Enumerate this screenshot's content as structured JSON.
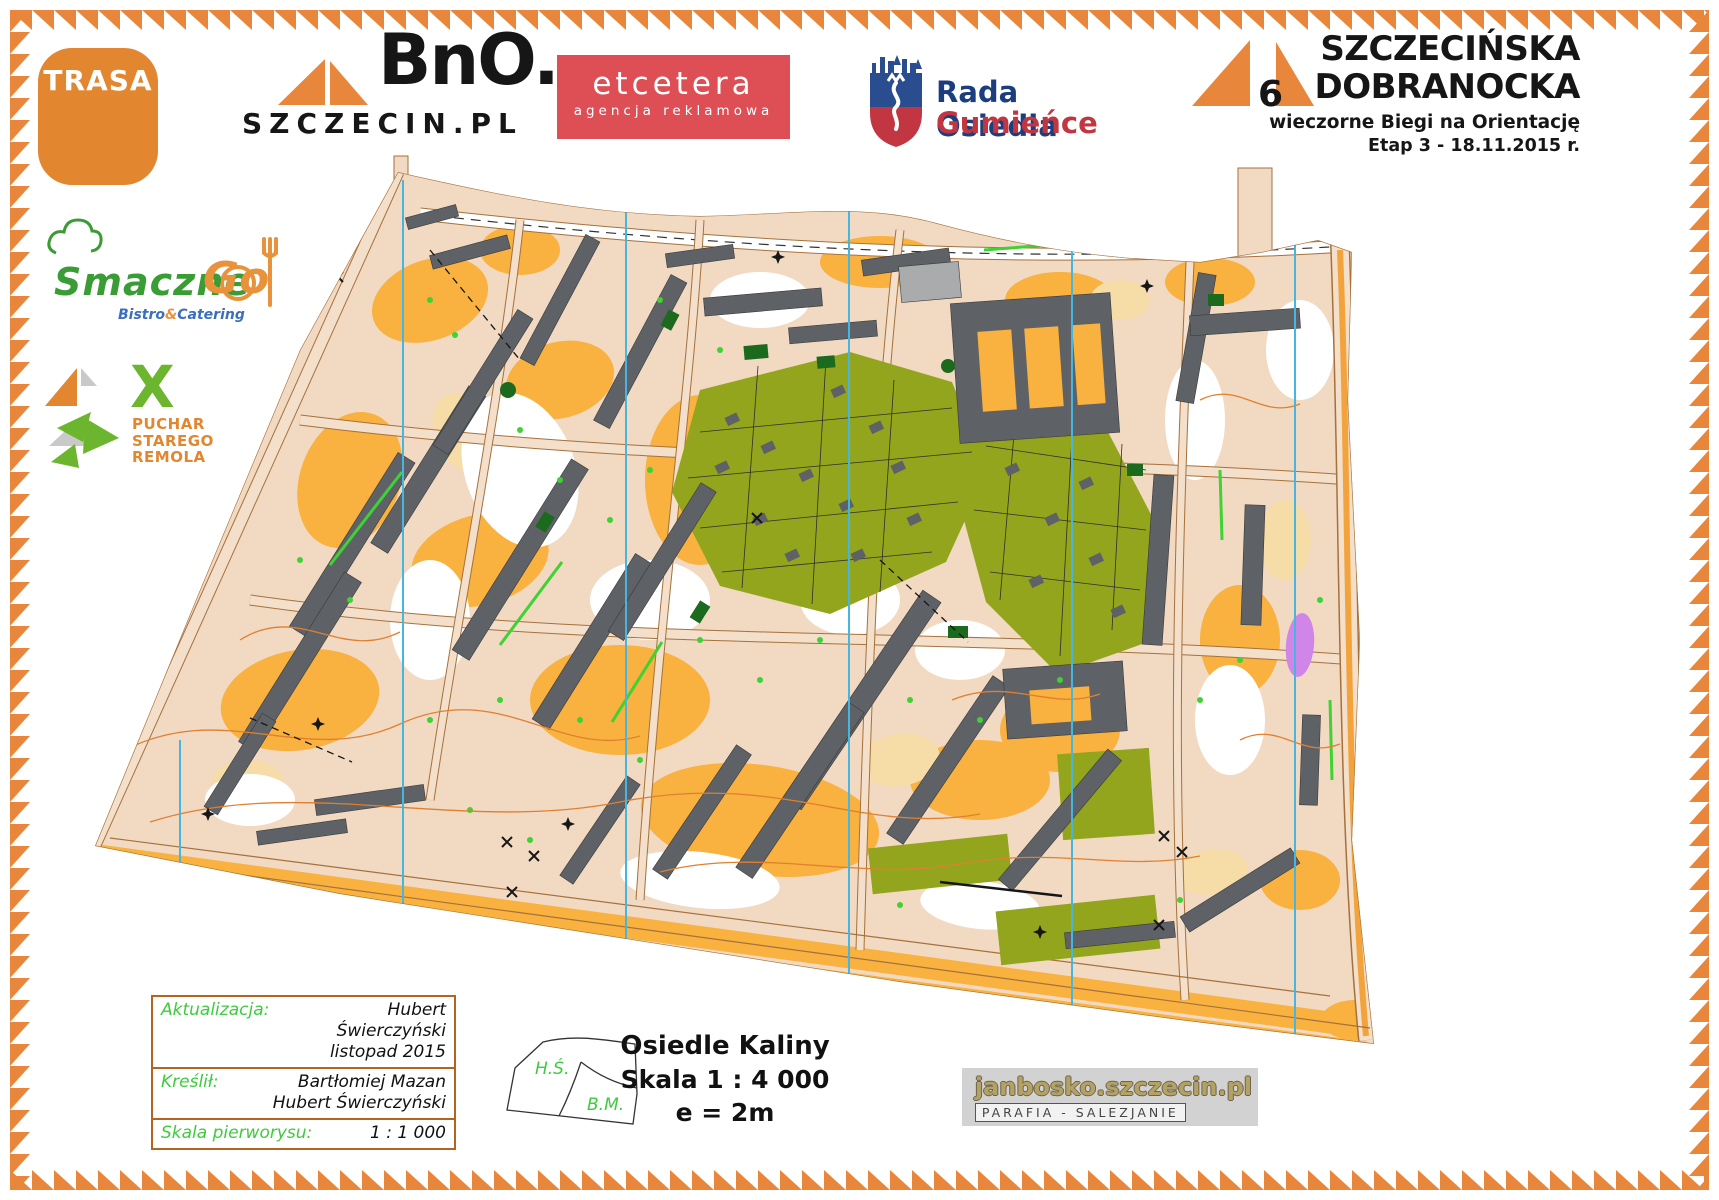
{
  "page": {
    "background": "#ffffff",
    "border_color": "#e8873b"
  },
  "header": {
    "trasa": {
      "label": "TRASA",
      "bg": "#e2862f"
    },
    "bno": {
      "name": "BnO.",
      "domain": "SZCZECIN.PL"
    },
    "etcetera": {
      "name": "etcetera",
      "tagline": "agencja reklamowa",
      "bg": "#dd4f55"
    },
    "rada": {
      "line1": "Rada Osiedla",
      "line2": "Gumieńce"
    },
    "event": {
      "number": "6",
      "title_line1": "SZCZECIŃSKA",
      "title_line2": "DOBRANOCKA",
      "subtitle": "wieczorne Biegi na Orientację",
      "stage": "Etap 3 - 18.11.2015 r."
    }
  },
  "sponsors": {
    "smacznego": {
      "word1": "Smaczne",
      "word2": "Go",
      "tagline_a": "Bistro",
      "tagline_amp": "&",
      "tagline_b": "Catering"
    },
    "puchar": {
      "x": "X",
      "line1": "PUCHAR",
      "line2": "STAREGO",
      "line3": "REMOLA"
    }
  },
  "credits": {
    "rows": [
      {
        "label": "Aktualizacja:",
        "values": [
          "Hubert Świerczyński",
          "listopad 2015"
        ]
      },
      {
        "label": "Kreślił:",
        "values": [
          "Bartłomiej Mazan",
          "Hubert Świerczyński"
        ]
      },
      {
        "label": "Skala pierworysu:",
        "values": [
          "1 : 1 000"
        ]
      }
    ]
  },
  "sketch": {
    "region_top": "H.Ś.",
    "region_bottom": "B.M."
  },
  "map_title": {
    "name": "Osiedle Kaliny",
    "scale": "Skala 1 : 4 000",
    "equidistance": "e = 2m"
  },
  "parafia": {
    "site": "janbosko.szczecin.pl",
    "tagline": "PARAFIA - SALEZJANIE"
  },
  "map_legend_colors": {
    "paved_beige": "#f1d9c2",
    "open_orange": "#f9b13f",
    "vegetation_olive": "#93a41d",
    "building_gray": "#5e6166",
    "bright_green": "#3ed233",
    "dark_green": "#1c6a1e",
    "meridian_blue": "#45b6e0",
    "contour_orange": "#df8030",
    "olympic_purple": "#cf86e8"
  }
}
